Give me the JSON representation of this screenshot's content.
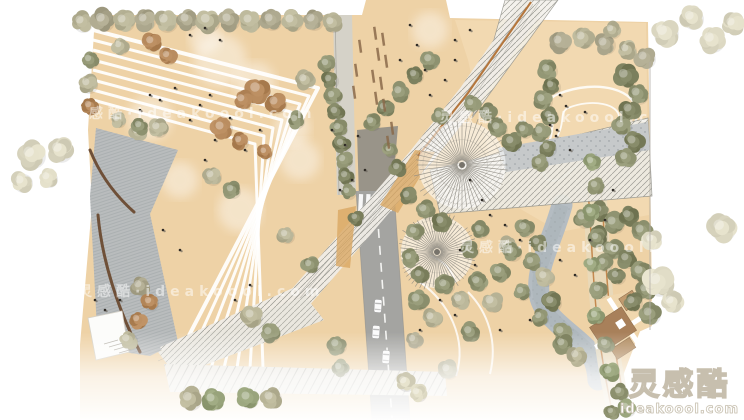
{
  "watermark": {
    "brand": "灵感酷",
    "domain": "ideakoool.com",
    "tiled_text": "灵感酷·ideakoool.com",
    "tile_positions": [
      [
        70,
        118
      ],
      [
        440,
        122
      ],
      [
        78,
        296
      ],
      [
        460,
        252
      ]
    ]
  },
  "palette": {
    "background": "#ffffff",
    "plaza_tan": "#eed2a6",
    "lawn_cream": "#f3dbb4",
    "paving_gray": "#b9bcbd",
    "road_gray": "#a4a4a1",
    "river_gray": "#b4bcc2",
    "structure_light": "#efece6",
    "structure_line": "#8d8d86",
    "accent_orange": "#c08044",
    "wall_brown": "#6f5038",
    "building_brown": "#a8805a",
    "deck_tan": "#d9a763"
  },
  "scene": {
    "canvas": {
      "w": 744,
      "h": 420
    },
    "base_points": "95,15 362,15 366,0 446,0 450,18 648,22 652,300 606,420 80,420 80,345 92,205 88,130",
    "lawn_points": "455,20 646,23 649,215 560,232 498,196 468,60",
    "paving_points": "96,128 178,150 150,214 178,342 150,356 98,348 90,196",
    "wall_paths": [
      "M 90,150 C 100,175 116,196 134,212",
      "M 98,215 C 102,260 118,310 140,352"
    ],
    "chevrons": [
      "93,30 318,88 172,368",
      "93,40 309,96 185,368",
      "93,50 300,104 198,368",
      "93,60 291,112 211,368",
      "93,70 282,120 224,368",
      "93,80 273,128 237,368",
      "93,90 264,136 250,368",
      "93,100 255,144 263,368"
    ],
    "clouds": [
      [
        220,
        60,
        26
      ],
      [
        255,
        82,
        20
      ],
      [
        150,
        118,
        22
      ],
      [
        292,
        128,
        18
      ],
      [
        205,
        38,
        16
      ],
      [
        430,
        30,
        18
      ],
      [
        300,
        160,
        20
      ],
      [
        240,
        210,
        22
      ],
      [
        180,
        180,
        18
      ]
    ],
    "lawn_loops": [
      "M 558,94 C 598,78 638,90 637,114 C 636,136 610,144 596,152 C 582,160 572,172 560,179 C 547,186 539,173 544,158 C 549,143 555,128 551,116 C 547,104 548,98 558,94 Z",
      "M 568,108 C 592,98 620,104 619,118 C 618,132 598,138 586,146 C 574,154 564,160 558,156 C 552,152 556,140 560,130 C 564,120 560,112 568,108 Z"
    ],
    "plaza_paths": [
      "M 420,282 C 448,302 468,338 456,376",
      "M 468,292 C 488,312 498,342 490,374",
      "M 430,255 C 445,262 452,270 455,282"
    ],
    "river_path": "M 562,205 C 552,242 536,266 539,293 C 542,316 568,330 586,348 C 594,357 597,366 598,380",
    "road": {
      "body": "356,191 394,191 410,420 372,420",
      "center_dash": "M 376,195 L 392,418",
      "edges": [
        "M 356,191 L 372,420",
        "M 394,191 L 410,420"
      ],
      "under_bridge_shadow": "357,130 398,126 392,196 359,199",
      "narrow_path": "333,15 352,15 356,195 337,195",
      "crosswalk_y": 194,
      "crosswalk_x0": 359,
      "crosswalk_n": 5,
      "crosswalk_step": 7.4
    },
    "cars": [
      [
        378,
        306
      ],
      [
        376,
        332
      ],
      [
        386,
        357
      ]
    ],
    "structure": {
      "spine": "M 533,4 L 470,95 L 420,158 L 363,225 L 300,298 L 165,358",
      "top_triangle": "505,0 558,0 472,118",
      "branch": "430,170 648,118 652,196 440,214",
      "branch_gravel": "498,148 648,122 650,150 506,172",
      "arm_a": "158,352 305,296 324,320 176,376",
      "arm_b": "164,364 445,372 447,396 170,392",
      "orange_edge": "M 531,2 L 468,93 L 418,156",
      "deck_tan_quads": [
        "415,150 435,152 398,213 380,205",
        "338,210 356,206 350,268 336,266"
      ]
    },
    "pavilions": [
      {
        "cx": 462,
        "cy": 165,
        "r": 46
      },
      {
        "cx": 437,
        "cy": 252,
        "r": 38
      }
    ],
    "terrace": {
      "band": "M 594,190 C 600,250 596,310 621,420",
      "orange_lines": [
        "M 588,192 C 594,252 590,312 614,420",
        "M 601,190 C 607,250 603,310 629,420"
      ]
    },
    "buildings": {
      "patch_points": "598,298 646,288 652,326 612,344",
      "origin": [
        615,
        330
      ],
      "rotation": -33,
      "rects": [
        [
          -20,
          -16,
          38,
          28,
          "#a8805a"
        ],
        [
          20,
          -24,
          16,
          14,
          "#c09a6e"
        ],
        [
          -14,
          14,
          22,
          12,
          "#b08a5e"
        ]
      ],
      "white_lanes": [
        "M -26,4 L 40,4",
        "M 12,-30 L 12,30"
      ]
    },
    "left_path_points": "88,318 122,311 129,352 96,360",
    "edge_line": "M 650,62 L 650,330",
    "tree_colors": [
      "#b6b295",
      "#8e9270",
      "#dbd7c1",
      "#b18457",
      "#7c805e",
      "#aaa58b",
      "#95a078"
    ],
    "trees": [
      [
        82,
        22,
        10,
        0
      ],
      [
        103,
        20,
        11,
        5
      ],
      [
        124,
        21,
        10,
        0
      ],
      [
        145,
        20,
        10,
        5
      ],
      [
        166,
        21,
        11,
        0
      ],
      [
        187,
        20,
        10,
        5
      ],
      [
        208,
        21,
        11,
        0
      ],
      [
        229,
        20,
        10,
        5
      ],
      [
        250,
        21,
        10,
        0
      ],
      [
        271,
        20,
        10,
        5
      ],
      [
        292,
        21,
        10,
        0
      ],
      [
        313,
        20,
        10,
        5
      ],
      [
        332,
        23,
        9,
        0
      ],
      [
        90,
        60,
        8,
        1
      ],
      [
        88,
        84,
        9,
        0
      ],
      [
        90,
        106,
        8,
        3
      ],
      [
        120,
        46,
        8,
        0
      ],
      [
        152,
        42,
        9,
        3
      ],
      [
        168,
        56,
        8,
        3
      ],
      [
        258,
        90,
        12,
        3
      ],
      [
        276,
        103,
        10,
        3
      ],
      [
        243,
        100,
        9,
        3
      ],
      [
        222,
        128,
        10,
        3
      ],
      [
        240,
        141,
        8,
        3
      ],
      [
        265,
        152,
        7,
        3
      ],
      [
        158,
        128,
        9,
        0
      ],
      [
        138,
        132,
        8,
        0
      ],
      [
        305,
        80,
        9,
        0
      ],
      [
        296,
        120,
        8,
        1
      ],
      [
        212,
        176,
        9,
        0
      ],
      [
        232,
        190,
        8,
        1
      ],
      [
        286,
        235,
        8,
        0
      ],
      [
        310,
        265,
        8,
        1
      ],
      [
        327,
        64,
        8,
        1
      ],
      [
        330,
        80,
        8,
        4
      ],
      [
        333,
        96,
        8,
        1
      ],
      [
        336,
        112,
        8,
        4
      ],
      [
        339,
        128,
        8,
        1
      ],
      [
        342,
        144,
        8,
        4
      ],
      [
        344,
        160,
        8,
        1
      ],
      [
        346,
        176,
        8,
        4
      ],
      [
        348,
        192,
        7,
        1
      ],
      [
        140,
        126,
        8,
        1
      ],
      [
        118,
        120,
        7,
        0
      ],
      [
        252,
        316,
        10,
        0
      ],
      [
        270,
        333,
        9,
        1
      ],
      [
        140,
        286,
        9,
        5
      ],
      [
        150,
        302,
        8,
        3
      ],
      [
        138,
        320,
        8,
        3
      ],
      [
        128,
        340,
        9,
        0
      ],
      [
        337,
        345,
        9,
        1
      ],
      [
        340,
        368,
        8,
        1
      ],
      [
        356,
        218,
        7,
        4
      ],
      [
        418,
        300,
        10,
        1
      ],
      [
        432,
        318,
        9,
        0
      ],
      [
        414,
        340,
        8,
        5
      ],
      [
        448,
        370,
        9,
        0
      ],
      [
        470,
        332,
        9,
        1
      ],
      [
        430,
        60,
        9,
        1
      ],
      [
        415,
        75,
        8,
        4
      ],
      [
        400,
        92,
        9,
        1
      ],
      [
        385,
        108,
        8,
        4
      ],
      [
        372,
        122,
        8,
        1
      ],
      [
        408,
        196,
        8,
        4
      ],
      [
        425,
        210,
        9,
        1
      ],
      [
        442,
        222,
        9,
        4
      ],
      [
        415,
        232,
        8,
        1
      ],
      [
        398,
        168,
        8,
        4
      ],
      [
        390,
        150,
        7,
        1
      ],
      [
        410,
        258,
        8,
        1
      ],
      [
        420,
        275,
        8,
        4
      ],
      [
        445,
        285,
        9,
        1
      ],
      [
        460,
        300,
        9,
        0
      ],
      [
        478,
        282,
        9,
        1
      ],
      [
        492,
        302,
        10,
        0
      ],
      [
        470,
        250,
        8,
        4
      ],
      [
        500,
        272,
        9,
        1
      ],
      [
        508,
        245,
        8,
        0
      ],
      [
        480,
        230,
        8,
        1
      ],
      [
        525,
        228,
        9,
        1
      ],
      [
        538,
        243,
        8,
        4
      ],
      [
        512,
        252,
        9,
        1
      ],
      [
        532,
        262,
        8,
        1
      ],
      [
        545,
        277,
        9,
        0
      ],
      [
        522,
        292,
        8,
        1
      ],
      [
        552,
        302,
        9,
        4
      ],
      [
        540,
        317,
        8,
        1
      ],
      [
        562,
        332,
        9,
        1
      ],
      [
        584,
        218,
        10,
        1
      ],
      [
        600,
        211,
        9,
        4
      ],
      [
        614,
        223,
        10,
        1
      ],
      [
        629,
        216,
        9,
        4
      ],
      [
        642,
        231,
        10,
        1
      ],
      [
        598,
        236,
        9,
        4
      ],
      [
        612,
        249,
        10,
        1
      ],
      [
        627,
        259,
        9,
        4
      ],
      [
        641,
        272,
        10,
        1
      ],
      [
        617,
        276,
        8,
        4
      ],
      [
        604,
        263,
        8,
        1
      ],
      [
        646,
        290,
        9,
        1
      ],
      [
        633,
        302,
        9,
        4
      ],
      [
        650,
        314,
        10,
        1
      ],
      [
        592,
        162,
        8,
        6
      ],
      [
        596,
        186,
        8,
        1
      ],
      [
        591,
        212,
        8,
        6
      ],
      [
        597,
        238,
        8,
        1
      ],
      [
        592,
        264,
        8,
        6
      ],
      [
        599,
        290,
        8,
        1
      ],
      [
        596,
        316,
        8,
        6
      ],
      [
        606,
        344,
        8,
        1
      ],
      [
        560,
        42,
        10,
        5
      ],
      [
        583,
        38,
        10,
        0
      ],
      [
        605,
        44,
        10,
        5
      ],
      [
        627,
        50,
        9,
        0
      ],
      [
        612,
        30,
        8,
        0
      ],
      [
        645,
        58,
        10,
        5
      ],
      [
        665,
        33,
        13,
        2
      ],
      [
        692,
        18,
        11,
        2
      ],
      [
        712,
        40,
        12,
        2
      ],
      [
        733,
        24,
        10,
        2
      ],
      [
        548,
        70,
        9,
        1
      ],
      [
        552,
        86,
        8,
        4
      ],
      [
        543,
        100,
        9,
        1
      ],
      [
        550,
        116,
        8,
        4
      ],
      [
        541,
        132,
        9,
        1
      ],
      [
        548,
        148,
        8,
        4
      ],
      [
        540,
        163,
        8,
        1
      ],
      [
        626,
        76,
        11,
        4
      ],
      [
        638,
        94,
        10,
        1
      ],
      [
        630,
        110,
        10,
        4
      ],
      [
        622,
        126,
        9,
        1
      ],
      [
        634,
        142,
        10,
        4
      ],
      [
        626,
        158,
        9,
        1
      ],
      [
        498,
        128,
        9,
        1
      ],
      [
        512,
        142,
        9,
        4
      ],
      [
        524,
        130,
        8,
        1
      ],
      [
        488,
        112,
        8,
        4
      ],
      [
        472,
        104,
        8,
        1
      ],
      [
        440,
        116,
        8,
        1
      ],
      [
        32,
        155,
        13,
        2
      ],
      [
        60,
        150,
        12,
        2
      ],
      [
        22,
        182,
        10,
        2
      ],
      [
        48,
        178,
        9,
        2
      ],
      [
        722,
        228,
        13,
        2
      ],
      [
        658,
        282,
        14,
        2
      ],
      [
        672,
        302,
        10,
        2
      ],
      [
        652,
        240,
        9,
        2
      ]
    ],
    "post_fade_trees": [
      [
        190,
        399,
        11,
        0
      ],
      [
        213,
        400,
        10,
        6
      ],
      [
        248,
        398,
        10,
        6
      ],
      [
        271,
        398,
        10,
        0
      ],
      [
        405,
        382,
        9,
        2
      ],
      [
        418,
        393,
        8,
        2
      ],
      [
        610,
        372,
        9,
        6
      ],
      [
        620,
        392,
        8,
        1
      ],
      [
        627,
        408,
        8,
        6
      ],
      [
        612,
        412,
        7,
        1
      ],
      [
        563,
        344,
        9,
        1
      ],
      [
        577,
        356,
        9,
        0
      ]
    ],
    "people": [
      [
        150,
        95
      ],
      [
        160,
        100
      ],
      [
        175,
        88
      ],
      [
        200,
        105
      ],
      [
        210,
        95
      ],
      [
        140,
        110
      ],
      [
        230,
        118
      ],
      [
        190,
        120
      ],
      [
        260,
        130
      ],
      [
        215,
        140
      ],
      [
        245,
        150
      ],
      [
        205,
        160
      ],
      [
        190,
        35
      ],
      [
        205,
        28
      ],
      [
        220,
        40
      ],
      [
        332,
        130
      ],
      [
        345,
        145
      ],
      [
        358,
        136
      ],
      [
        352,
        180
      ],
      [
        365,
        170
      ],
      [
        340,
        190
      ],
      [
        430,
        95
      ],
      [
        445,
        80
      ],
      [
        455,
        60
      ],
      [
        470,
        180
      ],
      [
        482,
        200
      ],
      [
        490,
        215
      ],
      [
        505,
        225
      ],
      [
        520,
        240
      ],
      [
        460,
        250
      ],
      [
        475,
        265
      ],
      [
        440,
        300
      ],
      [
        455,
        315
      ],
      [
        420,
        330
      ],
      [
        500,
        330
      ],
      [
        530,
        320
      ],
      [
        560,
        260
      ],
      [
        575,
        275
      ],
      [
        590,
        240
      ],
      [
        605,
        220
      ],
      [
        613,
        190
      ],
      [
        570,
        150
      ],
      [
        557,
        130
      ],
      [
        470,
        30
      ],
      [
        455,
        40
      ],
      [
        410,
        25
      ],
      [
        417,
        45
      ],
      [
        400,
        60
      ],
      [
        425,
        70
      ],
      [
        560,
        95
      ],
      [
        566,
        106
      ],
      [
        585,
        112
      ],
      [
        550,
        125
      ],
      [
        556,
        136
      ],
      [
        95,
        300
      ],
      [
        105,
        310
      ],
      [
        120,
        300
      ],
      [
        235,
        300
      ],
      [
        250,
        285
      ],
      [
        180,
        250
      ],
      [
        163,
        230
      ]
    ],
    "benches": [
      [
        373,
        27
      ],
      [
        381,
        33
      ],
      [
        376,
        48
      ],
      [
        384,
        55
      ],
      [
        371,
        70
      ],
      [
        379,
        77
      ],
      [
        374,
        92
      ],
      [
        382,
        99
      ],
      [
        358,
        40
      ],
      [
        354,
        64
      ],
      [
        352,
        86
      ],
      [
        390,
        122
      ],
      [
        386,
        136
      ]
    ]
  }
}
